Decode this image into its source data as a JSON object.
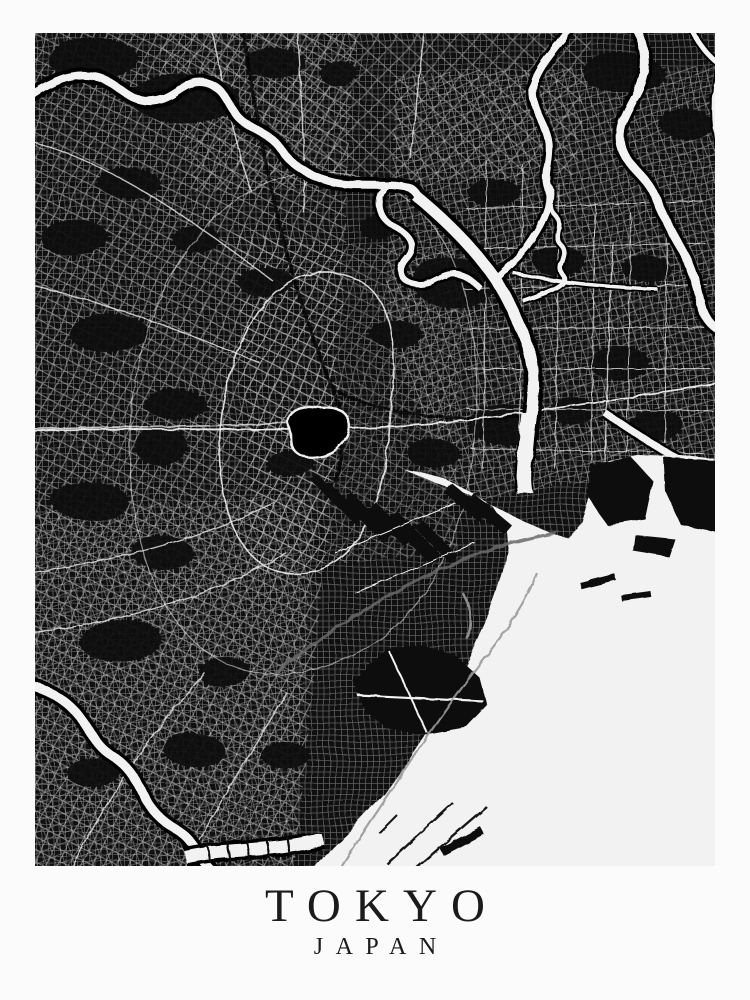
{
  "poster": {
    "title": "TOKYO",
    "subtitle": "JAPAN"
  },
  "map": {
    "label": "Black-and-white schematic street map of Tokyo with rivers, the port piers and Tokyo Bay in the lower right"
  },
  "colors": {
    "paper": "#fbfbfb",
    "map_ink": "#101010",
    "street_gray": "#d9d9d9",
    "water_white": "#f2f2f3",
    "title_text": "#1b1b1b"
  }
}
